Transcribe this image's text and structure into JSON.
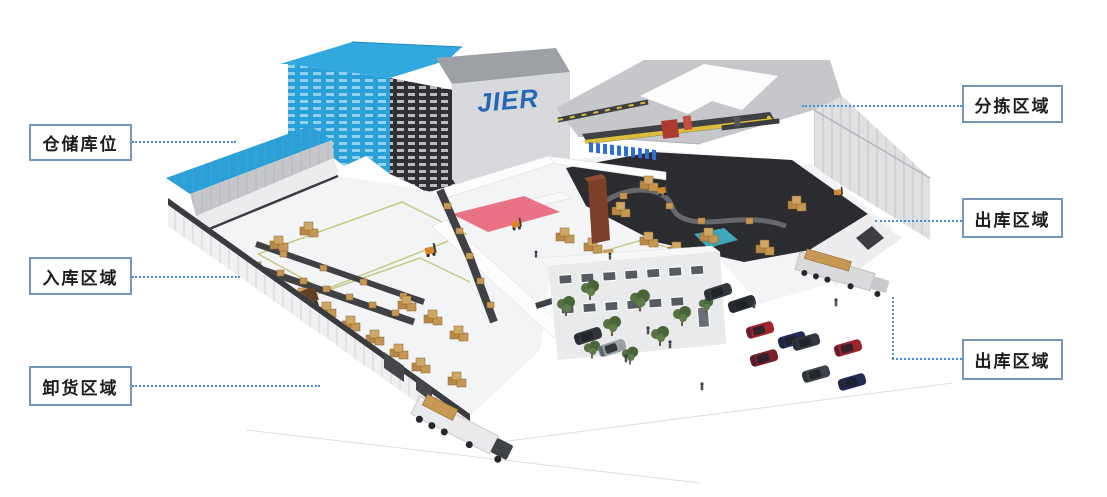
{
  "figure": {
    "description": "3D warehouse logistics overview with labeled functional zones"
  },
  "logo": {
    "text": "JIER",
    "color": "#2468b5"
  },
  "callouts": [
    {
      "id": "storage-area",
      "label": "仓储库位",
      "side": "left"
    },
    {
      "id": "inbound-area",
      "label": "入库区域",
      "side": "left"
    },
    {
      "id": "unloading-area",
      "label": "卸货区域",
      "side": "left"
    },
    {
      "id": "sorting-area",
      "label": "分拣区域",
      "side": "right"
    },
    {
      "id": "outbound-area-upper",
      "label": "出库区域",
      "side": "right"
    },
    {
      "id": "outbound-area-lower",
      "label": "出库区域",
      "side": "right"
    }
  ],
  "colors": {
    "callout_border": "#7497bd",
    "leader_line": "#4a90d8",
    "roof_blue": "#29a0d8",
    "logo_blue": "#2468b5",
    "box_tan": "#c79754",
    "dark_floor": "#2b2c2f",
    "red_zone": "#e5546d",
    "cyan_zone": "#3fb6c9",
    "tree_green": "#49663a",
    "car_red": "#9e2430",
    "car_navy": "#232c54",
    "car_charcoal": "#33373d",
    "sorter_yellow": "#ddbe3a",
    "chute_blue": "#2e6fd0"
  }
}
